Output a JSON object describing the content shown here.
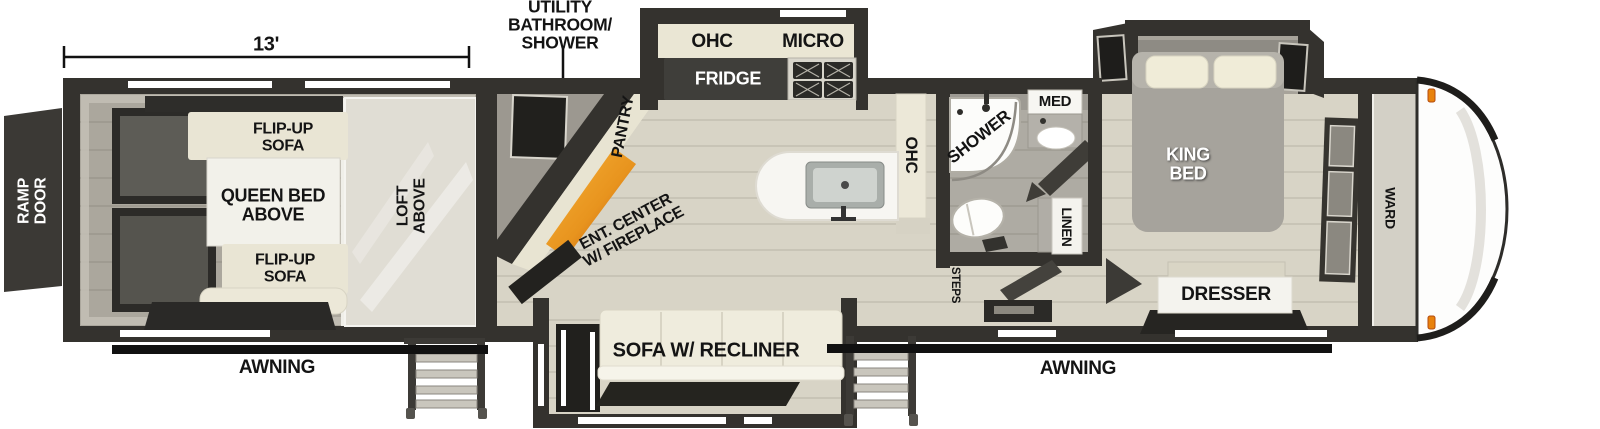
{
  "colors": {
    "wall": "#34322e",
    "floor": "#d8d4c6",
    "garage_floor": "#aba79d",
    "bath_floor": "#aeaba3",
    "cream_cabinet": "#eae6d4",
    "white_box": "#f4f3ee",
    "fireplace_orange": "#e8941e",
    "awning_bar": "#111111",
    "clearance_light": "#e8820c"
  },
  "garage": {
    "dimension": "13'",
    "ramp_door": "RAMP\nDOOR",
    "flip_up_sofa_top": "FLIP-UP\nSOFA",
    "queen_bed_above": "QUEEN BED\nABOVE",
    "flip_up_sofa_bottom": "FLIP-UP\nSOFA",
    "loft_above": "LOFT\nABOVE"
  },
  "living": {
    "utility_callout": "UTILITY\nBATHROOM/\nSHOWER",
    "pantry": "PANTRY",
    "ent_center": "ENT. CENTER\nW/ FIREPLACE",
    "ohc": "OHC",
    "micro": "MICRO",
    "fridge": "FRIDGE",
    "counter_ohc": "OHC",
    "sofa": "SOFA W/ RECLINER"
  },
  "bath": {
    "shower": "SHOWER",
    "med": "MED",
    "linen": "LINEN",
    "steps": "STEPS"
  },
  "bedroom": {
    "king_bed": "KING\nBED",
    "dresser": "DRESSER",
    "ward": "WARD"
  },
  "exterior": {
    "awning_left": "AWNING",
    "awning_right": "AWNING"
  }
}
